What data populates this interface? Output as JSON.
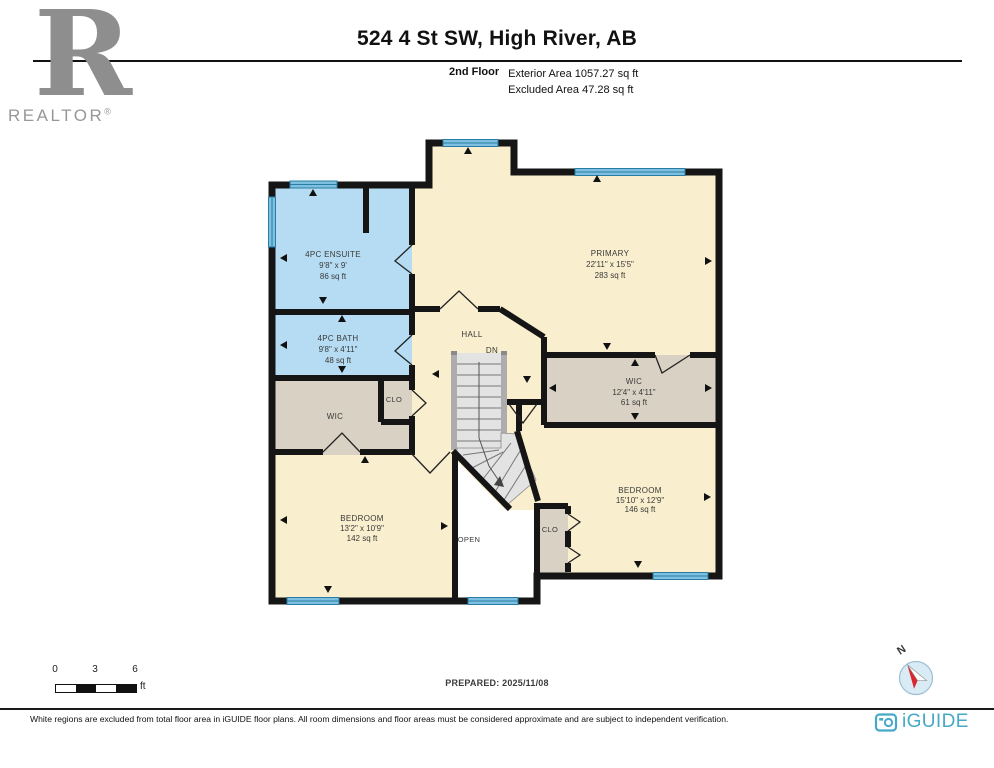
{
  "header": {
    "realtor_r": "R",
    "realtor_text": "REALTOR",
    "registered": "®",
    "title": "524 4 St SW, High River, AB",
    "floor_label": "2nd Floor",
    "exterior_area": "Exterior Area 1057.27 sq ft",
    "excluded_area": "Excluded Area 47.28 sq ft"
  },
  "rooms": {
    "ensuite": {
      "name": "4PC ENSUITE",
      "dims": "9'8\" x 9'",
      "area": "86 sq ft"
    },
    "bath": {
      "name": "4PC BATH",
      "dims": "9'8\" x 4'11\"",
      "area": "48 sq ft"
    },
    "wic_left": {
      "name": "WIC"
    },
    "clo_left": {
      "name": "CLO"
    },
    "hall": {
      "name": "HALL"
    },
    "primary": {
      "name": "PRIMARY",
      "dims": "22'11\" x 15'5\"",
      "area": "283 sq ft"
    },
    "wic_right": {
      "name": "WIC",
      "dims": "12'4\" x 4'11\"",
      "area": "61 sq ft"
    },
    "bedroom_left": {
      "name": "BEDROOM",
      "dims": "13'2\" x 10'9\"",
      "area": "142 sq ft"
    },
    "bedroom_right": {
      "name": "BEDROOM",
      "dims": "15'10\" x 12'9\"",
      "area": "146 sq ft"
    },
    "clo_right": {
      "name": "CLO"
    },
    "open": {
      "name": "OPEN"
    }
  },
  "stairs": {
    "dn_label": "DN"
  },
  "scale": {
    "ticks": [
      "0",
      "3",
      "6"
    ],
    "unit": "ft"
  },
  "footer": {
    "prepared": "PREPARED: 2025/11/08",
    "compass_n": "N",
    "disclaimer": "White regions are excluded from total floor area in iGUIDE floor plans. All room dimensions and floor areas must be considered approximate and are subject to independent verification.",
    "brand": "iGUIDE"
  },
  "colors": {
    "room_beige": "#F9EECD",
    "room_blue": "#B5DCF2",
    "room_gray": "#D9D2C4",
    "wall_black": "#151515",
    "window_blue": "#7EC0DF",
    "window_line": "#2B7CA4",
    "stairs_gray": "#E3E3E3",
    "iguide_teal": "#45A9C7",
    "compass_red": "#D9272E",
    "logo_gray": "#8E8E8E"
  }
}
